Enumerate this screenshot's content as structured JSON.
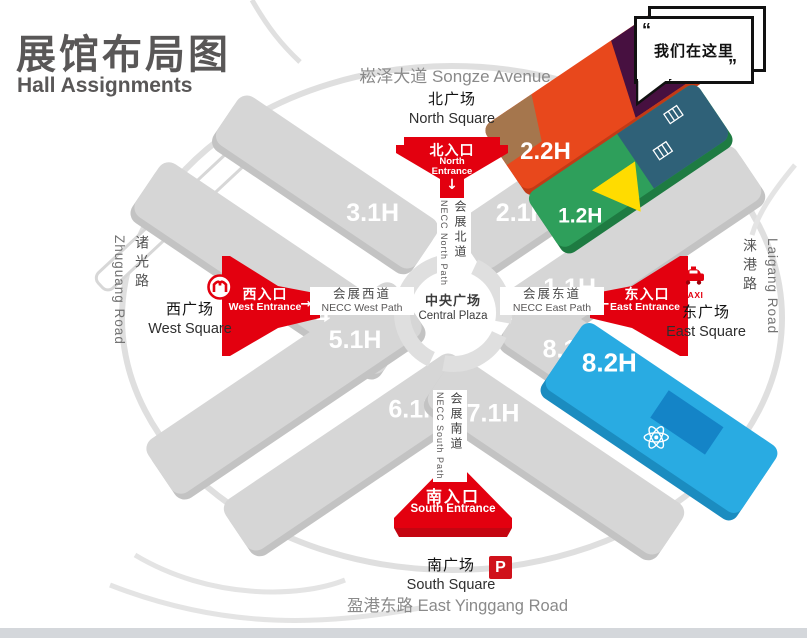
{
  "title": {
    "zh": "展馆布局图",
    "en": "Hall Assignments"
  },
  "speech_bubble": {
    "open_quote": "“",
    "text": "我们在这里",
    "close_quote": "”"
  },
  "avenues": {
    "north": {
      "zh": "崧泽大道",
      "en": "Songze Avenue"
    },
    "south": {
      "zh": "盈港东路",
      "en": "East Yinggang Road"
    },
    "west": {
      "zh": "诸光路",
      "en": "Zhuguang Road"
    },
    "east": {
      "zh": "涞港路",
      "en": "Laigang Road"
    }
  },
  "squares": {
    "north": {
      "zh": "北广场",
      "en": "North Square"
    },
    "south": {
      "zh": "南广场",
      "en": "South Square"
    },
    "west": {
      "zh": "西广场",
      "en": "West Square"
    },
    "east": {
      "zh": "东广场",
      "en": "East Square"
    }
  },
  "entrances": {
    "north": {
      "zh": "北入口",
      "en_line1": "North",
      "en_line2": "Entrance",
      "arrow": "↓"
    },
    "south": {
      "zh": "南入口",
      "en": "South Entrance",
      "arrow": "↑"
    },
    "west": {
      "zh": "西入口",
      "en": "West Entrance",
      "arrow": "→"
    },
    "east": {
      "zh": "东入口",
      "en": "East Entrance",
      "arrow": "←"
    }
  },
  "paths": {
    "north": {
      "zh": "会展北道",
      "en": "NECC North Path"
    },
    "south": {
      "zh": "会展南道",
      "en": "NECC South Path"
    },
    "west": {
      "zh": "会展西道",
      "en": "NECC West Path"
    },
    "east": {
      "zh": "会展东道",
      "en": "NECC East Path"
    }
  },
  "plaza": {
    "zh": "中央广场",
    "en": "Central Plaza"
  },
  "halls": {
    "h31": "3.1H",
    "h21": "2.1H",
    "h41": "4.1H",
    "h11": "1.1H",
    "h51": "5.1H",
    "h61": "6.1H",
    "h71": "7.1H",
    "h81": "8.1H",
    "h22": "2.2H",
    "h12": "1.2H",
    "h82": "8.2H"
  },
  "icons": {
    "taxi_label": "TAXI",
    "parking_label": "P"
  },
  "colors": {
    "entrance_red": "#E3000F",
    "hall_gray": "#D6D6D6",
    "h22_orange": "#E8481C",
    "h22_purple": "#471040",
    "h22_brown": "#A5764D",
    "h12_green": "#2E9F5B",
    "h12_yellow": "#FFDC00",
    "h12_teal": "#2F6178",
    "h82_blue": "#29ABE2",
    "h82_panel": "#1484C7",
    "title_gray": "#595757",
    "road_text_gray": "#8A8A8A"
  }
}
